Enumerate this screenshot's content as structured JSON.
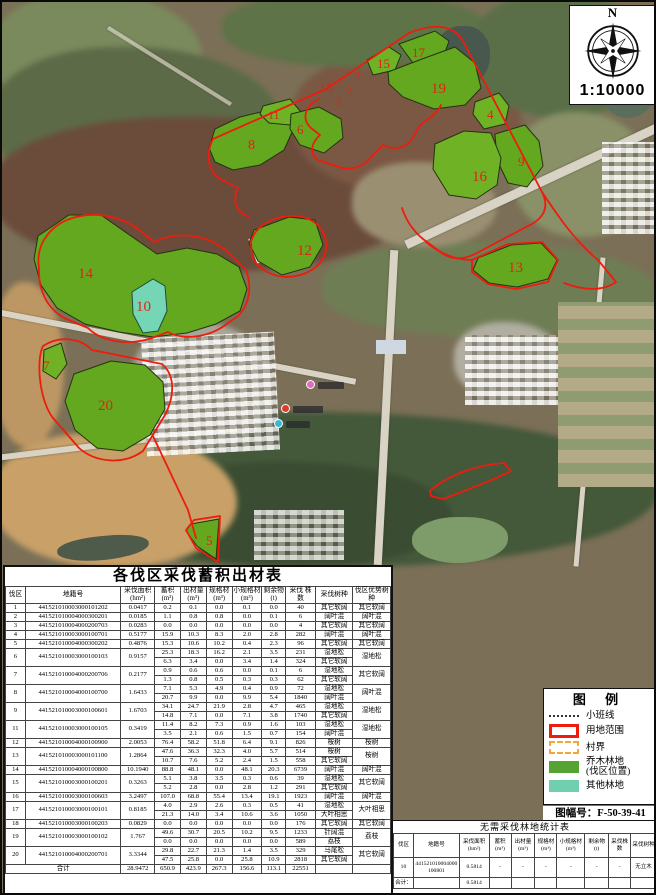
{
  "map": {
    "compass": {
      "north": "N",
      "scale": "1:10000"
    },
    "plot_labels": [
      {
        "text": "1",
        "x": 354,
        "y": 76,
        "s": 9
      },
      {
        "text": "2",
        "x": 345,
        "y": 92,
        "s": 9
      },
      {
        "text": "3",
        "x": 334,
        "y": 104,
        "s": 9
      },
      {
        "text": "4",
        "x": 485,
        "y": 117,
        "s": 13
      },
      {
        "text": "5",
        "x": 204,
        "y": 543,
        "s": 13
      },
      {
        "text": "6",
        "x": 295,
        "y": 132,
        "s": 13
      },
      {
        "text": "7",
        "x": 41,
        "y": 368,
        "s": 13
      },
      {
        "text": "8",
        "x": 246,
        "y": 147,
        "s": 14
      },
      {
        "text": "9",
        "x": 516,
        "y": 164,
        "s": 13
      },
      {
        "text": "10",
        "x": 134,
        "y": 309,
        "s": 15
      },
      {
        "text": "11",
        "x": 266,
        "y": 117,
        "s": 12
      },
      {
        "text": "12",
        "x": 295,
        "y": 253,
        "s": 15
      },
      {
        "text": "13",
        "x": 506,
        "y": 270,
        "s": 15
      },
      {
        "text": "14",
        "x": 76,
        "y": 276,
        "s": 15
      },
      {
        "text": "15",
        "x": 375,
        "y": 66,
        "s": 13
      },
      {
        "text": "16",
        "x": 470,
        "y": 179,
        "s": 15
      },
      {
        "text": "17",
        "x": 410,
        "y": 55,
        "s": 13
      },
      {
        "text": "18",
        "x": 318,
        "y": 90,
        "s": 13
      },
      {
        "text": "19",
        "x": 429,
        "y": 91,
        "s": 15
      },
      {
        "text": "20",
        "x": 96,
        "y": 408,
        "s": 15
      }
    ]
  },
  "legend": {
    "title": "图 例",
    "items": [
      {
        "type": "sw-line",
        "label": "小班线"
      },
      {
        "type": "sw-red",
        "label": "用地范围"
      },
      {
        "type": "sw-village",
        "label": "村界"
      },
      {
        "type": "sw-green",
        "label": "乔木林地\n(伐区位置)"
      },
      {
        "type": "sw-teal",
        "label": "其他林地"
      }
    ],
    "sheet_number": "图幅号：F-50-39-41"
  },
  "main_table": {
    "title": "各伐区采伐蓄积出材表",
    "headers": [
      "伐区",
      "地籍号",
      "采伐面积\n(hm²)",
      "蓄积\n(m³)",
      "出材量\n(m³)",
      "规格材\n(m³)",
      "小规格材\n(m³)",
      "剩余物\n(t)",
      "采伐 株数",
      "采伐树种",
      "伐区优势树种"
    ],
    "rows": [
      {
        "id": "1",
        "cad": "441521010003000101202",
        "area": "0.0417",
        "sub": [
          [
            "0.2",
            "0.1",
            "0.0",
            "0.1",
            "0.0",
            "40",
            "其它软阔"
          ]
        ],
        "dom": "其它软阔"
      },
      {
        "id": "2",
        "cad": "441521010004000300201",
        "area": "0.0185",
        "sub": [
          [
            "1.1",
            "0.8",
            "0.8",
            "0.0",
            "0.1",
            "6",
            "阔叶混"
          ]
        ],
        "dom": "阔叶混"
      },
      {
        "id": "3",
        "cad": "441521010004000200703",
        "area": "0.0283",
        "sub": [
          [
            "0.0",
            "0.0",
            "0.0",
            "0.0",
            "0.0",
            "4",
            "其它软阔"
          ]
        ],
        "dom": "其它软阔"
      },
      {
        "id": "4",
        "cad": "441521010003000100701",
        "area": "0.5177",
        "sub": [
          [
            "15.9",
            "10.3",
            "8.3",
            "2.0",
            "2.8",
            "282",
            "阔叶混"
          ]
        ],
        "dom": "阔叶混"
      },
      {
        "id": "5",
        "cad": "441521010004000300202",
        "area": "0.4876",
        "sub": [
          [
            "15.3",
            "10.6",
            "10.2",
            "0.4",
            "2.3",
            "96",
            "其它软阔"
          ]
        ],
        "dom": "其它软阔"
      },
      {
        "id": "6",
        "cad": "441521010003000100103",
        "area": "0.9157",
        "sub": [
          [
            "25.3",
            "18.3",
            "16.2",
            "2.1",
            "3.5",
            "231",
            "湿地松"
          ],
          [
            "6.3",
            "3.4",
            "0.0",
            "3.4",
            "1.4",
            "324",
            "其它软阔"
          ]
        ],
        "dom": "湿地松"
      },
      {
        "id": "7",
        "cad": "441521010004000200706",
        "area": "0.2177",
        "sub": [
          [
            "0.9",
            "0.6",
            "0.6",
            "0.0",
            "0.1",
            "6",
            "湿地松"
          ],
          [
            "1.3",
            "0.8",
            "0.5",
            "0.3",
            "0.3",
            "62",
            "其它软阔"
          ]
        ],
        "dom": "其它软阔"
      },
      {
        "id": "8",
        "cad": "441521010004000100700",
        "area": "1.6433",
        "sub": [
          [
            "7.1",
            "5.3",
            "4.9",
            "0.4",
            "0.9",
            "72",
            "湿地松"
          ],
          [
            "20.7",
            "9.9",
            "0.0",
            "9.9",
            "5.4",
            "1840",
            "阔叶混"
          ]
        ],
        "dom": "阔叶混"
      },
      {
        "id": "9",
        "cad": "441521010003000100601",
        "area": "1.6703",
        "sub": [
          [
            "34.1",
            "24.7",
            "21.9",
            "2.8",
            "4.7",
            "465",
            "湿地松"
          ],
          [
            "14.8",
            "7.1",
            "0.0",
            "7.1",
            "3.8",
            "1740",
            "其它软阔"
          ]
        ],
        "dom": "湿地松"
      },
      {
        "id": "11",
        "cad": "441521010003000100105",
        "area": "0.3419",
        "sub": [
          [
            "11.4",
            "8.2",
            "7.3",
            "0.9",
            "1.6",
            "103",
            "湿地松"
          ],
          [
            "3.5",
            "2.1",
            "0.6",
            "1.5",
            "0.7",
            "154",
            "阔叶混"
          ]
        ],
        "dom": "湿地松"
      },
      {
        "id": "12",
        "cad": "441521010004000100900",
        "area": "2.0053",
        "sub": [
          [
            "76.4",
            "58.2",
            "51.8",
            "6.4",
            "9.1",
            "826",
            "桉树"
          ]
        ],
        "dom": "桉树"
      },
      {
        "id": "13",
        "cad": "441521010003000101100",
        "area": "1.2864",
        "sub": [
          [
            "47.6",
            "36.3",
            "32.3",
            "4.0",
            "5.7",
            "514",
            "桉树"
          ],
          [
            "10.7",
            "7.6",
            "5.2",
            "2.4",
            "1.5",
            "558",
            "其它软阔"
          ]
        ],
        "dom": "桉树"
      },
      {
        "id": "14",
        "cad": "441521010004000100800",
        "area": "10.1940",
        "sub": [
          [
            "88.8",
            "48.1",
            "0.0",
            "48.1",
            "20.3",
            "6739",
            "阔叶混"
          ]
        ],
        "dom": "阔叶混"
      },
      {
        "id": "15",
        "cad": "441521010003000100201",
        "area": "0.3263",
        "sub": [
          [
            "5.1",
            "3.8",
            "3.5",
            "0.3",
            "0.6",
            "39",
            "湿地松"
          ],
          [
            "5.2",
            "2.8",
            "0.0",
            "2.8",
            "1.2",
            "291",
            "其它软阔"
          ]
        ],
        "dom": "其它软阔"
      },
      {
        "id": "16",
        "cad": "441521010003000100603",
        "area": "3.2497",
        "sub": [
          [
            "107.0",
            "68.8",
            "55.4",
            "13.4",
            "19.1",
            "1923",
            "阔叶混"
          ]
        ],
        "dom": "阔叶混"
      },
      {
        "id": "17",
        "cad": "441521010003000100101",
        "area": "0.8185",
        "sub": [
          [
            "4.0",
            "2.9",
            "2.6",
            "0.3",
            "0.5",
            "41",
            "湿地松"
          ],
          [
            "21.3",
            "14.0",
            "3.4",
            "10.6",
            "3.6",
            "1050",
            "大叶相思"
          ]
        ],
        "dom": "大叶相思"
      },
      {
        "id": "18",
        "cad": "441521010003000100203",
        "area": "0.0829",
        "sub": [
          [
            "0.0",
            "0.0",
            "0.0",
            "0.0",
            "0.0",
            "176",
            "其它软阔"
          ]
        ],
        "dom": "其它软阔"
      },
      {
        "id": "19",
        "cad": "441521010003000100102",
        "area": "1.767",
        "sub": [
          [
            "49.6",
            "30.7",
            "20.5",
            "10.2",
            "9.5",
            "1233",
            "针阔混"
          ],
          [
            "0.0",
            "0.0",
            "0.0",
            "0.0",
            "0.0",
            "589",
            "荔枝"
          ]
        ],
        "dom": "荔枝"
      },
      {
        "id": "20",
        "cad": "441521010004000200701",
        "area": "3.3344",
        "sub": [
          [
            "29.8",
            "22.7",
            "21.3",
            "1.4",
            "3.5",
            "329",
            "马尾松"
          ],
          [
            "47.5",
            "25.8",
            "0.0",
            "25.8",
            "10.9",
            "2818",
            "其它软阔"
          ]
        ],
        "dom": "其它软阔"
      }
    ],
    "total": {
      "label": "合计",
      "area": "28.9472",
      "values": [
        "650.9",
        "423.9",
        "267.3",
        "156.6",
        "113.1",
        "22551"
      ]
    }
  },
  "no_cut_table": {
    "title": "无需采伐林地统计表",
    "headers": [
      "伐区",
      "地籍号",
      "采伐面积\n(hm²)",
      "蓄积\n(m³)",
      "出材量\n(m³)",
      "规格材\n(m³)",
      "小规格材\n(m³)",
      "剩余物\n(t)",
      "采伐株数",
      "采伐树种"
    ],
    "row": {
      "id": "10",
      "cad": "441521010004000100801",
      "area": "0.5814",
      "dashes": [
        "-",
        "-",
        "-",
        "-",
        "-",
        "-"
      ],
      "species": "无立木"
    },
    "total": {
      "label": "合计：",
      "area": "0.5814"
    }
  },
  "colors": {
    "boundary_red": "#ee1c0c",
    "plot_green": "#63a81f",
    "other_forest_teal": "#74d6b4",
    "village_border_orange": "#f2a636"
  }
}
